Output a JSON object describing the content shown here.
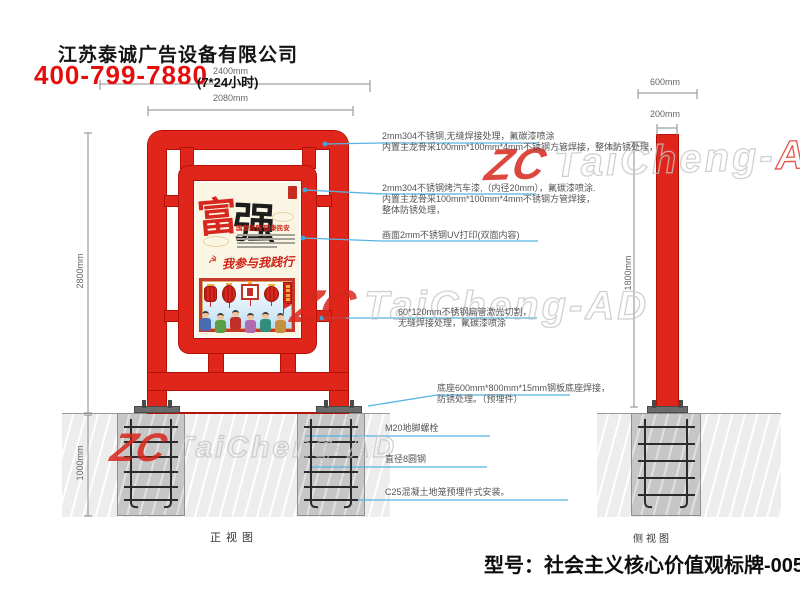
{
  "header": {
    "company": "江苏泰诚广告设备有限公司",
    "phone": "400-799-7880",
    "hours": "(7*24小时)"
  },
  "views": {
    "front_label": "正视图",
    "side_label": "侧视图"
  },
  "dimensions": {
    "front_width_outer": "2400mm",
    "front_width_inner": "2080mm",
    "front_height": "2800mm",
    "foundation_depth": "1000mm",
    "side_base_width": "600mm",
    "side_pole_width": "200mm",
    "side_pole_height": "1800mm"
  },
  "callouts": {
    "c1a": "2mm304不锈钢,无缝焊接处理，氟碳漆喷涂",
    "c1b": "内置主龙骨采100mm*100mm*4mm不锈钢方管焊接，整体防锈处理，",
    "c2a": "2mm304不锈钢烤汽车漆,（内径20mm），氟碳漆喷涂.",
    "c2b": "内置主龙骨采100mm*100mm*4mm不锈钢方管焊接，",
    "c2c": "整体防锈处理，",
    "c3": "画面2mm不锈钢UV打印(双面内容)",
    "c4a": "60*120mm不锈钢扁管激光切割，",
    "c4b": "无缝焊接处理，氟碳漆喷涂",
    "c5a": "底座600mm*800mm*15mm钢板底座焊接，",
    "c5b": "防锈处理。（预埋件）",
    "c6": "M20地脚螺栓",
    "c7": "直径8圆钢",
    "c8": "C25混凝土地笼预埋件式安装。"
  },
  "poster": {
    "char_left": "富",
    "char_right": "强",
    "subtitle": "国富民强 国泰民安",
    "emblem": "☭",
    "slogan": "我参与我践行"
  },
  "watermark": {
    "logo": "ZC",
    "text": "TaiCheng-AD",
    "text_gray": "TaiCheng-",
    "text_red": "AD"
  },
  "footer": {
    "model": "型号：社会主义核心价值观标牌-0057"
  },
  "colors": {
    "structure_red": "#e0251b",
    "leader_cyan": "#55b4e4",
    "foundation_gray": "#c6c6c6",
    "phone_red": "#e60d0d"
  }
}
